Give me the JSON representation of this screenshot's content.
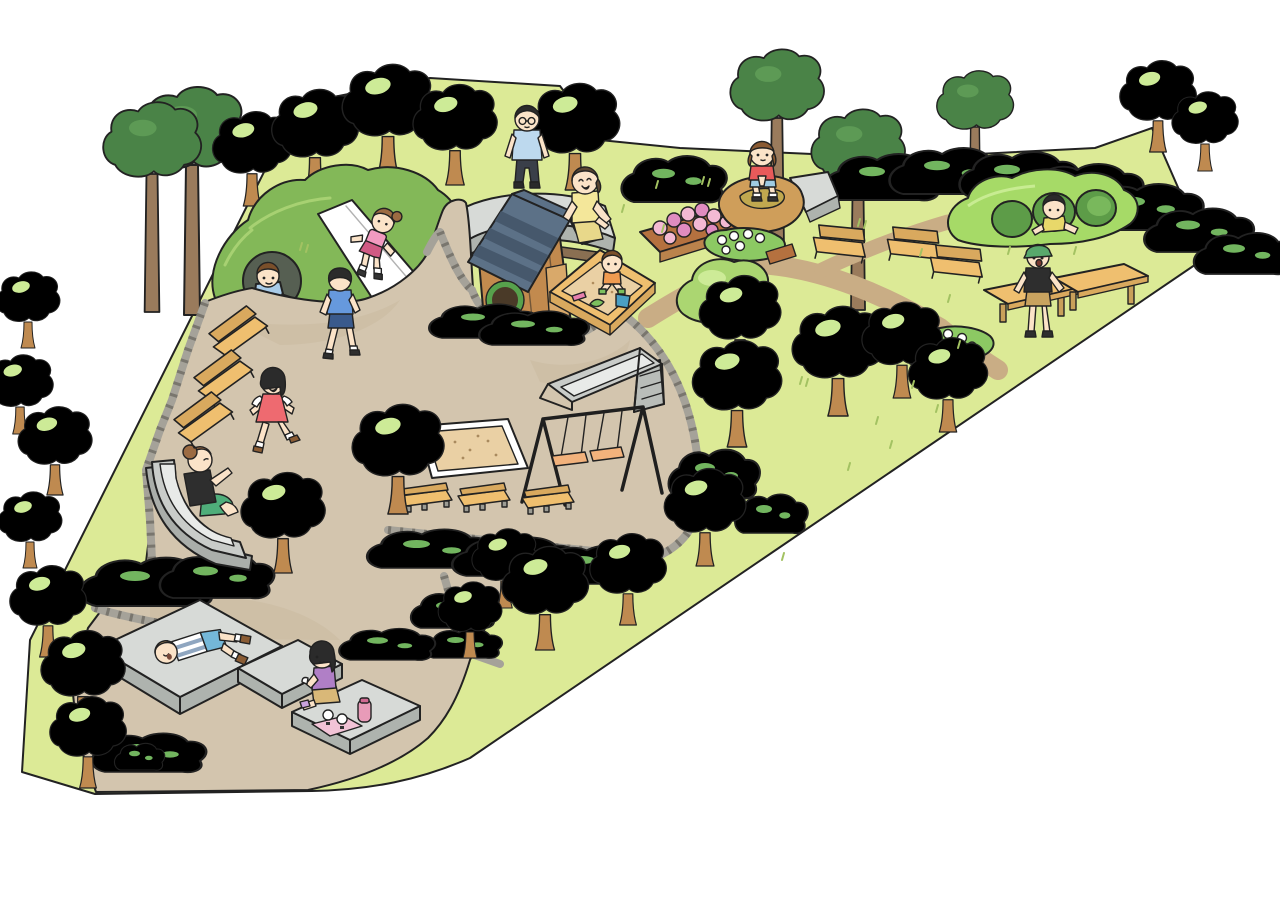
{
  "scene": {
    "type": "illustrated-park-map",
    "description": "Cartoon bird's-eye illustration of a neighborhood park with playground equipment, winding paths, trees and families playing. No text labels are rendered in the image.",
    "palette": {
      "bg": "#ffffff",
      "outline": "#222222",
      "grass": "#dcea96",
      "path": "#d3c5ae",
      "dirt": "#c9ad85",
      "cobble": "#a5a299",
      "cobbleDark": "#55524a",
      "hill": "#83b858",
      "hillHi": "#a7d172",
      "treeLight": "#abd671",
      "treeLightHi": "#cdeb97",
      "treeMid": "#8cc163",
      "treeDark": "#4a8347",
      "treeDarkHi": "#5d9a55",
      "trunk": "#bf8a50",
      "trunkTall": "#9a7b5c",
      "bush": "#4f9347",
      "bushHi": "#72b55f",
      "wood": "#efbf6f",
      "woodDark": "#d9a95e",
      "planter": "#b5713f",
      "stoneTop": "#d7dad7",
      "stoneSide": "#aeb3ae",
      "stoneBase": "#8a6f52",
      "sand": "#ead0a4",
      "white": "#ffffff",
      "skin": "#fbe3c8",
      "tuftColor": "#a3c262",
      "mound": "#a6da67",
      "moundHole": "#5d9c48",
      "slideMetal": "#c9ccc9",
      "roof": "#5c7187",
      "roofDark": "#46586c",
      "houseWall": "#c28a4e",
      "windowRing": "#57a14c",
      "flowerPink": "#f3b9d3",
      "flowerPinkDark": "#e08cc0",
      "rock": "#cf9e5a",
      "rockHi": "#c0a84f"
    },
    "areas": [
      {
        "name": "grass-lawn",
        "desc": "yellow-green park lawn shaped like a wide triangle on white background"
      },
      {
        "name": "main-plaza-path",
        "desc": "large sandy walking plaza through the middle and bottom of the park"
      },
      {
        "name": "dirt-trail",
        "desc": "narrow dirt trail crossing the right lawn toward the picnic tables"
      },
      {
        "name": "cobblestone-edging",
        "desc": "gray cobble borders along path edges and hedge beds"
      }
    ],
    "playground_equipment": [
      {
        "name": "grass-hill-slide",
        "desc": "green mound with white slide and crawl tunnel"
      },
      {
        "name": "wooden-playhouse",
        "desc": "small wooden house with blue shingle roof and round green window"
      },
      {
        "name": "sandbox",
        "desc": "wood-framed sandbox with bucket and shovels"
      },
      {
        "name": "metal-slide",
        "desc": "steel slide with ladder"
      },
      {
        "name": "swing-set",
        "desc": "black A-frame swing set with two swings"
      },
      {
        "name": "sand-pit",
        "desc": "large bordered sand play area"
      },
      {
        "name": "toddler-slide",
        "desc": "gray curved slide at lower left"
      },
      {
        "name": "tunnel-mound",
        "desc": "green play mound with three round tunnel holes at upper right"
      },
      {
        "name": "low-platforms",
        "desc": "three light-gray sitting platforms at the bottom"
      }
    ],
    "furniture": [
      {
        "name": "benches-left",
        "count": 3
      },
      {
        "name": "benches-center",
        "count": 3
      },
      {
        "name": "benches-upper-right",
        "count": 3
      },
      {
        "name": "picnic-tables",
        "count": 2
      },
      {
        "name": "curved-stone-bench",
        "count": 1
      },
      {
        "name": "stone-wall-piece",
        "count": 1
      }
    ],
    "vegetation": [
      {
        "name": "round-trees",
        "desc": "many light green round trees with short trunks"
      },
      {
        "name": "tall-trees",
        "desc": "tall dark green trees with long trunks along top and left"
      },
      {
        "name": "hedges",
        "desc": "dark green hedge rows in center, bottom and along the upper right edge"
      },
      {
        "name": "pink-flower-planter",
        "desc": "wooden planter full of pink flowers"
      },
      {
        "name": "white-flower-beds",
        "count": 2
      }
    ],
    "people": [
      {
        "name": "girl-on-hill-slide",
        "desc": "girl in pink shirt sliding down white hill slide"
      },
      {
        "name": "boy-in-tunnel",
        "desc": "boy in light blue shirt crawling out of hill tunnel"
      },
      {
        "name": "boy-walking",
        "desc": "boy in blue hoodie walking on plaza"
      },
      {
        "name": "girl-running",
        "desc": "girl in red dress running on plaza"
      },
      {
        "name": "woman-on-toddler-slide",
        "desc": "woman in black top and green pants at bottom of curved slide"
      },
      {
        "name": "man-on-stone-bench",
        "desc": "man with glasses and light blue shirt sitting on curved stone bench"
      },
      {
        "name": "mother-at-sandbox",
        "desc": "mother in yellow top kneeling by sandbox"
      },
      {
        "name": "toddler-in-sandbox",
        "desc": "toddler in orange shirt playing with blue bucket"
      },
      {
        "name": "girl-on-rock",
        "desc": "girl in red shirt squatting on big brown rock"
      },
      {
        "name": "boy-in-mound-hole",
        "desc": "boy in yellow shirt popping out of tunnel mound"
      },
      {
        "name": "boy-with-cap",
        "desc": "boy in green cap and black tee standing by picnic tables"
      },
      {
        "name": "boy-lying-on-platform",
        "desc": "boy in striped shirt lying on gray platform"
      },
      {
        "name": "girl-picnicking",
        "desc": "girl in purple top eating rice balls on platform with thermos"
      }
    ]
  }
}
